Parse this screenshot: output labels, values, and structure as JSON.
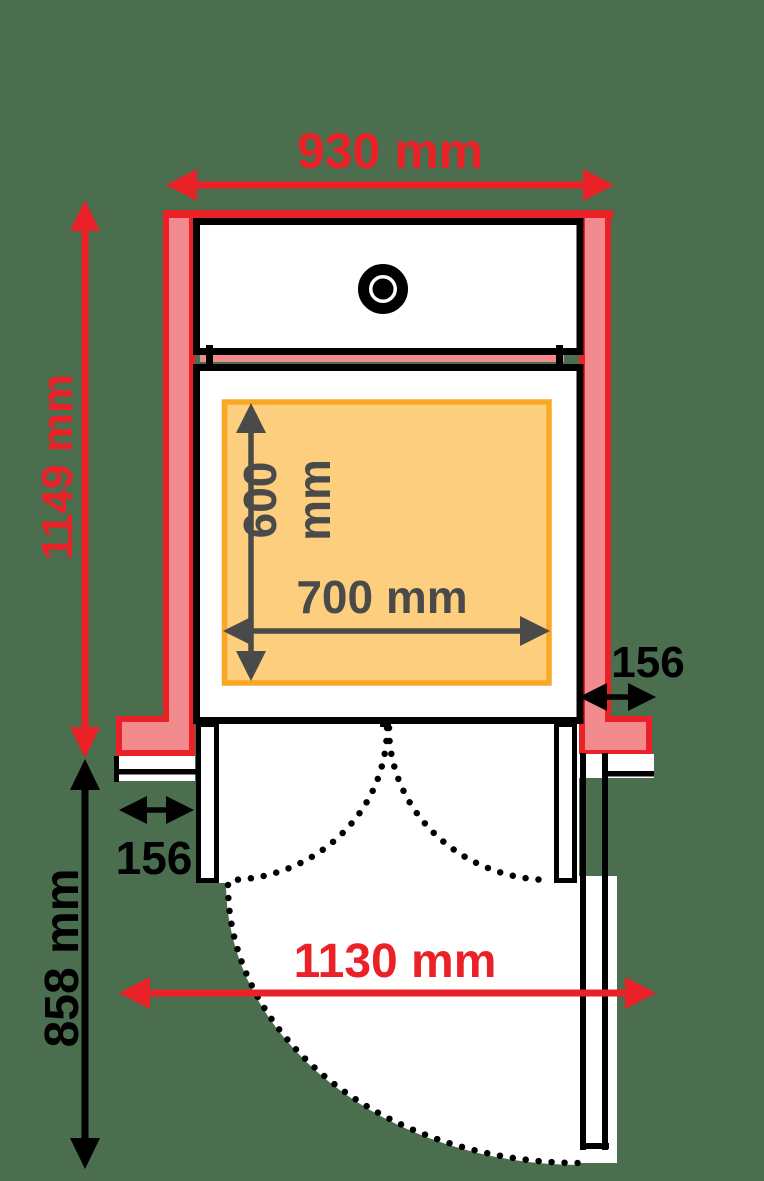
{
  "colors": {
    "background": "#4A6E4E",
    "wall_fill": "#F28B8D",
    "accent_red": "#EA2127",
    "zone_fill": "#FCCE7D",
    "zone_border": "#F9A825",
    "measure_gray": "#4A4A4A",
    "line_black": "#000000",
    "white": "#FFFFFF"
  },
  "labels": {
    "shaft_width": "930 mm",
    "shaft_depth": "1149 mm",
    "platform_depth_value": "600",
    "platform_depth_unit": "mm",
    "platform_width": "700 mm",
    "right_wall_thickness": "156",
    "left_wall_thickness": "156",
    "approach_depth": "858 mm",
    "door_swing_width": "1130 mm"
  }
}
